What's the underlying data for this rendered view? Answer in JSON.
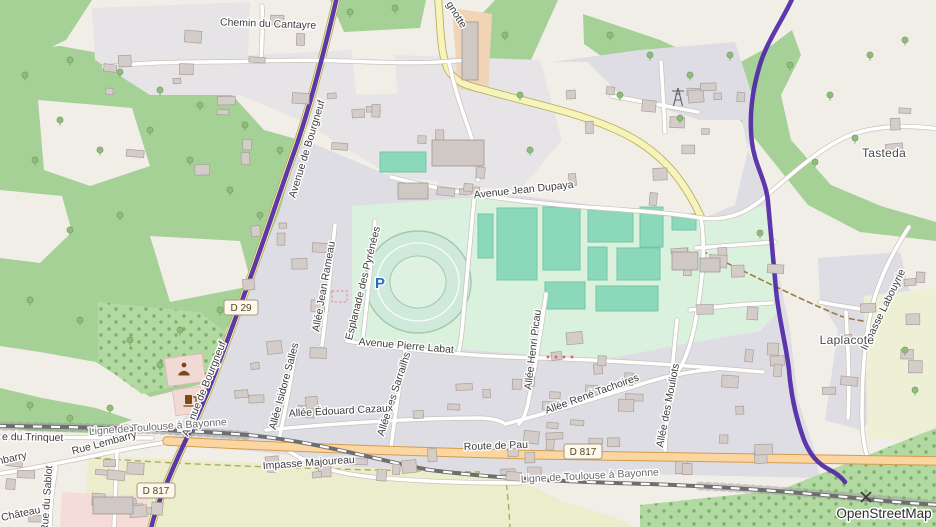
{
  "attribution": "OpenStreetMap",
  "labels": {
    "chemin_cantayre": "Chemin du Cantayre",
    "gnotte": "gnotte",
    "avenue_jean_dupaya": "Avenue Jean Dupaya",
    "tasteda": "Tasteda",
    "avenue_bourgneuf_n": "Avenue de Bourgneuf",
    "avenue_bourgneuf_s": "Avenue de Bourgneuf",
    "allee_jean_rameau": "Allée Jean Rameau",
    "esplanade_pyrenees": "Esplanade des Pyrénées",
    "allee_isidore_salles": "Allée Isidore Salles",
    "avenue_pierre_labat": "Avenue Pierre Labat",
    "allee_sarrailhs": "Allée des Sarrailhs",
    "allee_henri_picau": "Allée Henri Picau",
    "allee_edouard_cazaux": "Allée Édouard Cazaux",
    "allee_rene_tachoires": "Allée René Tachoires",
    "allee_mouliots": "Allée des Mouliots",
    "route_de_pau": "Route de Pau",
    "ligne_toulouse_bayonne_w": "Ligne de Toulouse à Bayonne",
    "ligne_toulouse_bayonne_e": "Ligne de Toulouse à Bayonne",
    "impasse_majoureau": "Impasse Majoureau",
    "rue_lembarry": "Rue Lembarry",
    "rue_lembarry_partial": "Lembarry",
    "rue_du_trinquet_partial": "e du Trinquet",
    "chateau_partial": "Château",
    "rue_du_sablot": "Rue du Sablot",
    "impasse_labouyrie": "Impasse Labouyrie",
    "laplacote": "Laplacote"
  },
  "badges": {
    "d29": "D 29",
    "d817_main": "D 817",
    "d817_sw": "D 817"
  },
  "poi": {
    "parking": "P"
  },
  "colors": {
    "boundary_purple": "#4f28a6",
    "primary_road_orange": "#fbd6a0",
    "secondary_road_yellow": "#f6f3bb",
    "forest_green": "#a5d096",
    "pitch_teal": "#8bd9ba",
    "residential_gray": "#dfdde4",
    "sports_mint": "#daf1de",
    "farmland": "#ecedcc",
    "parking_blue": "#2a66c8"
  }
}
